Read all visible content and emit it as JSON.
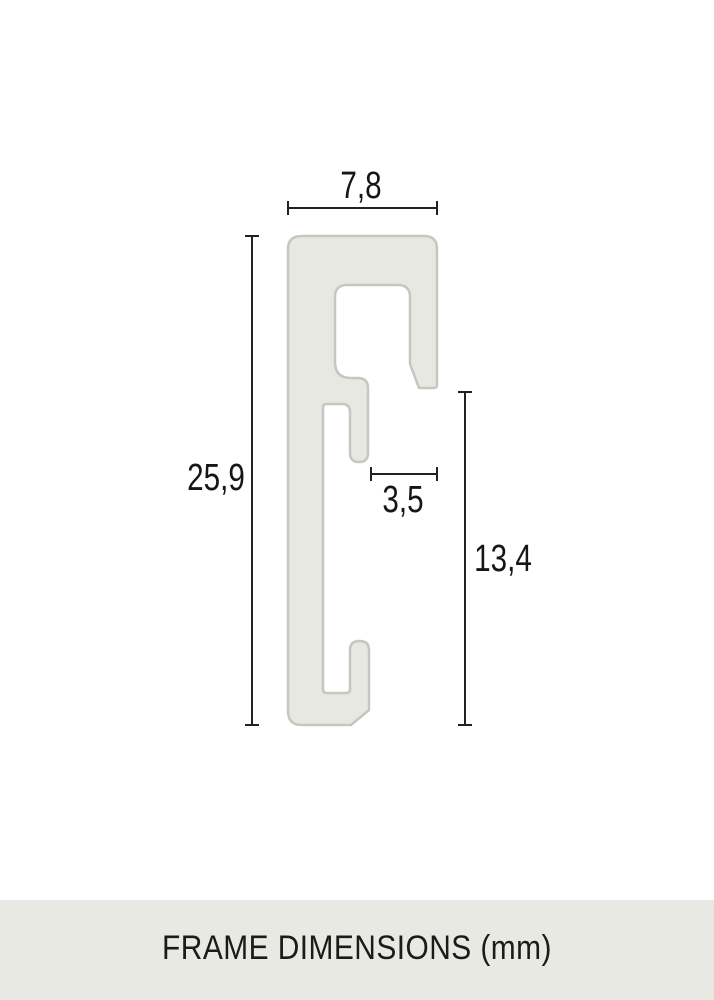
{
  "diagram": {
    "description": "frame-profile-cross-section",
    "dimensions": {
      "top_width": "7,8",
      "left_height": "25,9",
      "inner_width": "3,5",
      "right_height": "13,4"
    },
    "colors": {
      "profile_fill": "#e8e8e3",
      "profile_stroke": "#c6c7c1",
      "dimension_line": "#222222",
      "label_text": "#161616",
      "footer_background": "#e9e9e4"
    }
  },
  "footer": {
    "caption": "FRAME DIMENSIONS (mm)",
    "unit": "mm"
  }
}
